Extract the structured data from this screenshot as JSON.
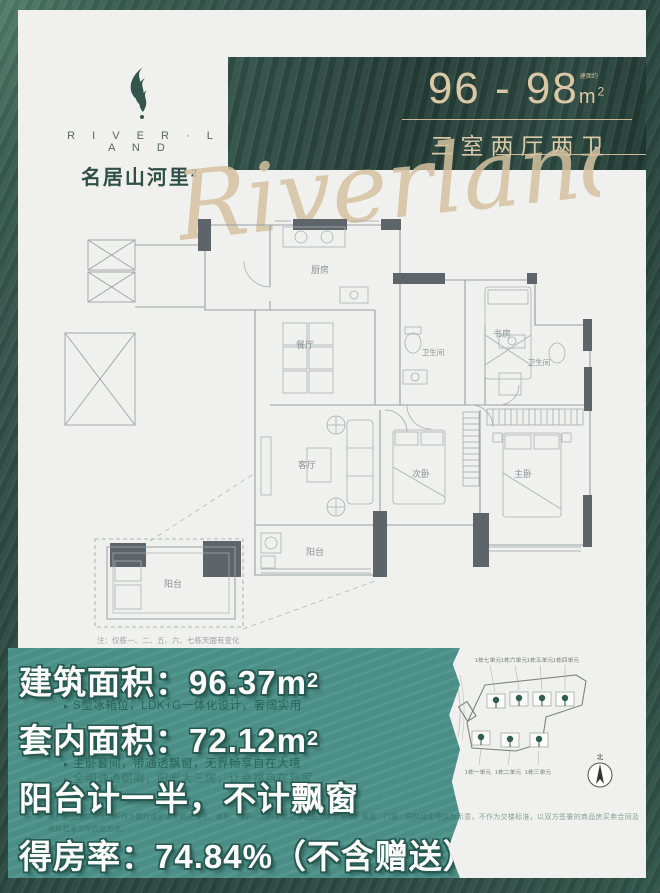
{
  "brand": {
    "logo_en": "R I V E R · L A N D",
    "logo_cn": "名居山河里",
    "logo_sup": "2",
    "watermark": "Riverland"
  },
  "header": {
    "area_range": "96 - 98",
    "area_unit": "m",
    "area_exp": "2",
    "area_note": "建面约",
    "layout_type": "三室两厅两卫"
  },
  "floorplan": {
    "rooms": {
      "kitchen": "厨房",
      "dining": "餐厅",
      "bath1": "卫生间",
      "study": "书房",
      "bath2": "卫生间",
      "living": "客厅",
      "bedroom2": "次卧",
      "master": "主卧",
      "balcony": "阳台",
      "balcony_detail": "阳台"
    },
    "note": "注：仅栋一、二、五、六、七栋天面有变化"
  },
  "site_plan": {
    "units_top": [
      "1栋七单元",
      "1栋六单元",
      "1栋五单元",
      "1栋四单元"
    ],
    "units_bottom": [
      "1栋一单元",
      "1栋二单元",
      "1栋三单元"
    ],
    "compass_label": "北"
  },
  "stats": {
    "bullet_arrow": "▸",
    "row1": "建筑面积：96.37m",
    "row1_sup": "2",
    "bullet1": "S型冰箱位，LDK+G一体化设计，奢阔实用",
    "row2": "套内面积：72.12m",
    "row2_sup": "2",
    "bullet2": "主卧套间，带通透飘窗，无界畅享自在大境",
    "bullet3": "全明通透朝南，阳光大三房，让幸福自在到家",
    "row3": "阳台计一半，不计飘窗",
    "fine_print": "本户型图仅供参考，不作为要约或承诺，相关尺寸、面积、布局以政府最终批准图纸为准；装修、家具、门窗、园林绿化等仅为示意，不作为交楼标准，以双方签署的商品房买卖合同及政府批准文件约定为准。",
    "row4": "得房率：74.84%（不含赠送）"
  },
  "colors": {
    "accent_teal": "#4d938a",
    "deep_green": "#2c4a41",
    "gold": "#d7c5a3"
  }
}
